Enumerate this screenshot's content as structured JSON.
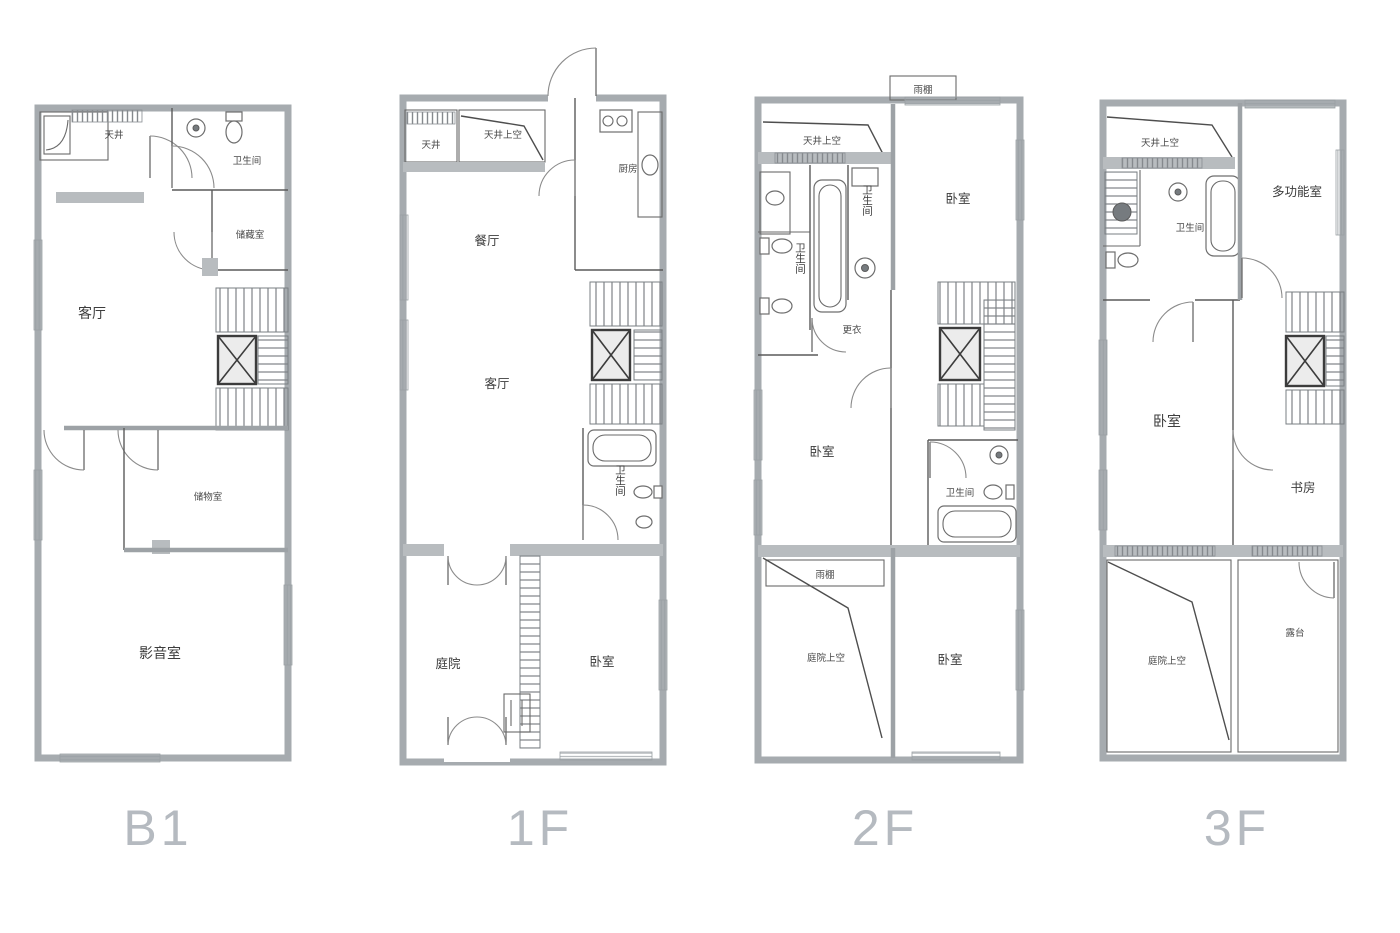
{
  "document": {
    "type": "residential-floor-plan-set",
    "background": "#ffffff"
  },
  "colors": {
    "wall": "#a6abaf",
    "line": "#5a5a5a",
    "room_label": "#3d3d3d",
    "floor_label": "#b5bac0"
  },
  "floors": [
    {
      "label": "B1",
      "rooms": {
        "lightwell": "天井",
        "bathroom": "卫生间",
        "storage_a": "储藏室",
        "living": "客厅",
        "storage_b": "储物室",
        "media_room": "影音室"
      }
    },
    {
      "label": "1F",
      "rooms": {
        "lightwell": "天井",
        "lightwell_void": "天井上空",
        "kitchen": "厨房",
        "dining": "餐厅",
        "living": "客厅",
        "bathroom": "卫生间",
        "courtyard": "庭院",
        "bedroom": "卧室"
      }
    },
    {
      "label": "2F",
      "rooms": {
        "lightwell_void": "天井上空",
        "canopy_top": "雨棚",
        "bathroom_left": "卫生间",
        "bathroom_small": "卫生间",
        "dressing": "更衣",
        "bedroom_top": "卧室",
        "bedroom_mid": "卧室",
        "bathroom_right": "卫生间",
        "canopy_bottom": "雨棚",
        "courtyard_void": "庭院上空",
        "bedroom_bottom": "卧室"
      }
    },
    {
      "label": "3F",
      "rooms": {
        "lightwell_void": "天井上空",
        "bathroom": "卫生间",
        "multipurpose": "多功能室",
        "bedroom": "卧室",
        "study": "书房",
        "courtyard_void": "庭院上空",
        "terrace": "露台"
      }
    }
  ]
}
